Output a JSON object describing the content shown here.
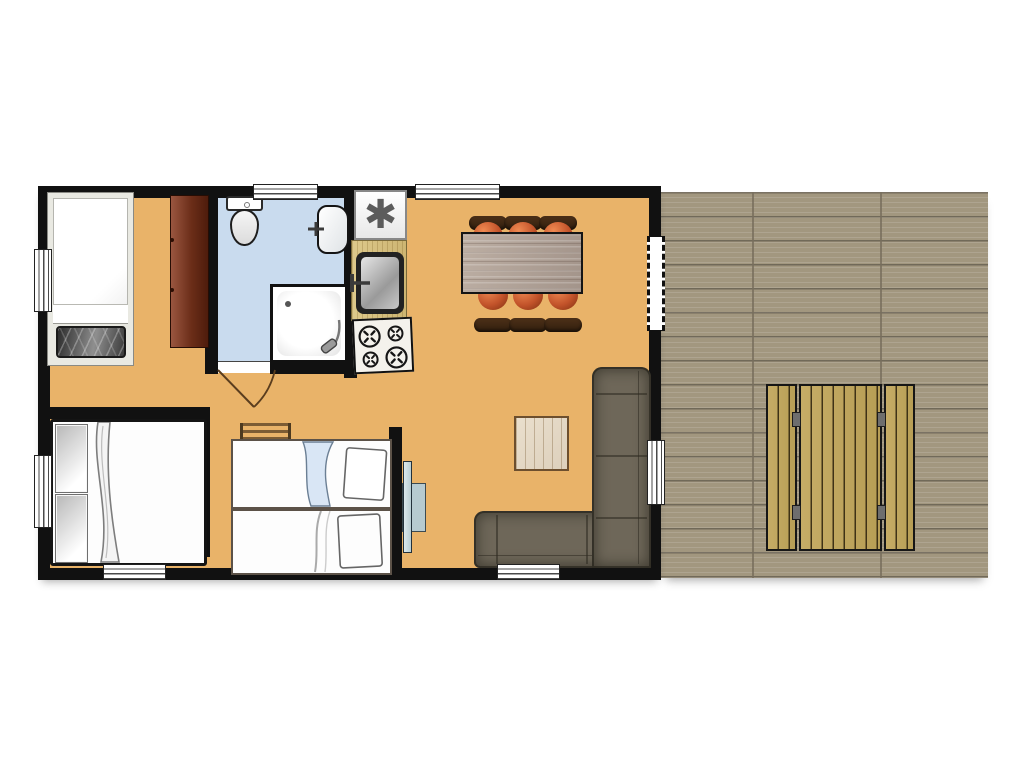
{
  "plan": {
    "type": "mobile-home floor plan with wooden deck",
    "rooms": [
      {
        "name": "bedroom-single",
        "furniture": [
          "single-bed",
          "wardrobe"
        ]
      },
      {
        "name": "bathroom",
        "furniture": [
          "toilet",
          "washbasin",
          "shower"
        ],
        "floor_color": "#c9dbee"
      },
      {
        "name": "kitchen",
        "furniture": [
          "fridge-freezer",
          "kitchen-sink",
          "stove-4-burners"
        ]
      },
      {
        "name": "living-dining",
        "furniture": [
          "dining-table",
          "six-chairs",
          "corner-sofa",
          "square-rug",
          "wall-tv"
        ]
      },
      {
        "name": "bedroom-double",
        "furniture": [
          "double-bed"
        ]
      },
      {
        "name": "bedroom-bunks",
        "furniture": [
          "bunk-bed-upper",
          "bunk-bed-lower",
          "ladder"
        ]
      },
      {
        "name": "deck-terrace",
        "furniture": [
          "picnic-table-with-two-benches"
        ]
      }
    ],
    "openings": {
      "windows_top": 2,
      "windows_bottom": 2,
      "windows_left": 2,
      "windows_right": 1,
      "sliding_door_right": 1,
      "bathroom_door_with_swing": 1
    },
    "counts": {
      "dining_chairs": 6,
      "picnic_benches": 2,
      "beds": 4
    }
  },
  "icons": {
    "freezer_symbol": "✱"
  },
  "colors": {
    "floor": "#e9b369",
    "walls": "#111111",
    "bathroom_floor": "#c9dbee",
    "deck_wood": "#a2977f",
    "picnic_wood": "#bfa55e",
    "wardrobe": "#6b2d18",
    "counter_wood": "#d5bf7e",
    "dining_table_wood": "#b0a297",
    "chair_seat": "#c2532a",
    "chair_back": "#3f2815",
    "sofa": "#6e6759",
    "rug": "#e2d7c4",
    "tv": "#b6cad0",
    "bunk_blanket": "#d9e6f5"
  }
}
